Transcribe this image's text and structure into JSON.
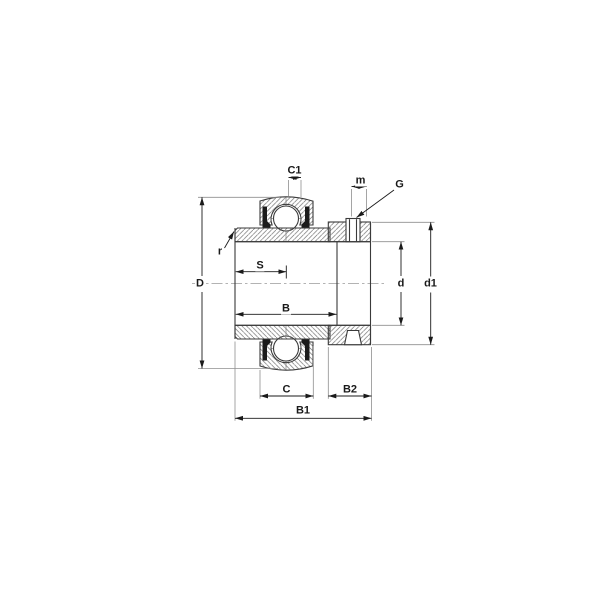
{
  "drawing": {
    "kind": "bearing-insert-cross-section",
    "labels": {
      "c1": "C1",
      "m": "m",
      "g": "G",
      "r": "r",
      "s": "S",
      "d_outer": "D",
      "b": "B",
      "d_bore": "d",
      "d1": "d1",
      "c": "C",
      "b2": "B2",
      "b1": "B1"
    }
  },
  "colors": {
    "background": "#ffffff",
    "outline": "#3a3a3a",
    "dimension": "#1a1a1a",
    "extension": "#8f8f8f",
    "hatch": "#6f6f6f",
    "seal": "#1b1b1b"
  }
}
